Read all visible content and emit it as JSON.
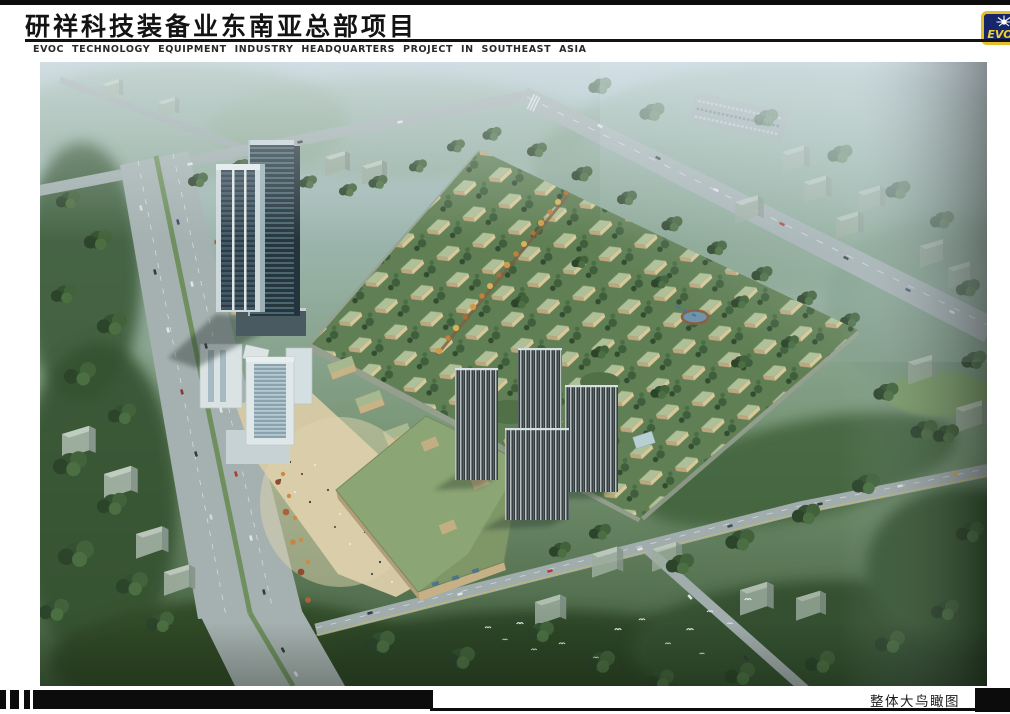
{
  "header": {
    "title_cn": "研祥科技装备业东南亚总部项目",
    "subtitle_en": "EVOC TECHNOLOGY EQUIPMENT INDUSTRY HEADQUARTERS PROJECT IN SOUTHEAST ASIA",
    "logo": {
      "text": "EVOC",
      "icon": "sunburst-icon",
      "bg_color": "#16266b",
      "border_color": "#e5be2b",
      "text_color": "#f2d22e"
    }
  },
  "figure": {
    "type": "architectural-aerial-rendering",
    "description": "Bird's-eye rendering of the EVOC headquarters masterplan: twin glass office towers and a commercial street along the western boulevard, a large green-roofed exhibition hall with sandy pedestrian plaza, four dark striped residential slabs, and a dense diamond-shaped field of green-roofed low-rise industrial villas, surrounded by tree-lined arterial roads, hazy context housing blocks and forest, with birds flying over the woods in the foreground.",
    "palette": {
      "haze_sky": "#b8cad2",
      "forest_dark": "#2c4522",
      "forest_mid": "#3d5d32",
      "road_gray": "#a7b1b1",
      "villa_roof_green": "#b4c397",
      "villa_wall_tan": "#e0cb98",
      "plaza_sand": "#dccca4",
      "big_green_roof": "#8ea570",
      "office_tower_glass": "#2b3a46",
      "residential_tower_dark": "#2c3133",
      "autumn_tree_orange": "#c67f30",
      "pond_blue": "#6e93a8"
    }
  },
  "footer": {
    "caption": "整体大鸟瞰图"
  }
}
